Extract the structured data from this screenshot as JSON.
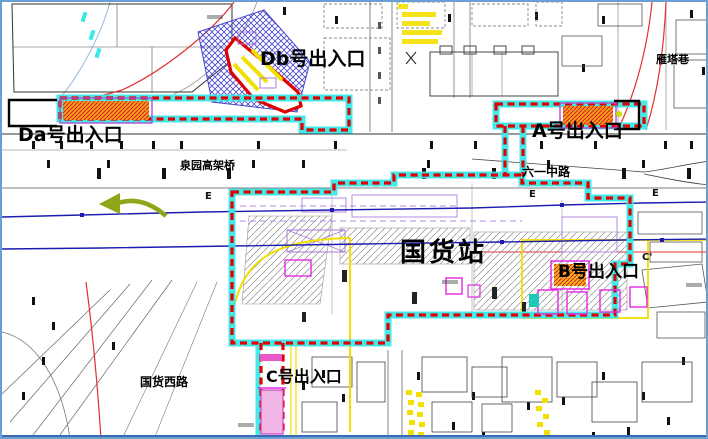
{
  "map": {
    "station_label": "国货站",
    "entrances": {
      "da": "Da号出入口",
      "db": "Db号出入口",
      "a": "A号出入口",
      "b": "B号出入口",
      "c": "C号出入口"
    },
    "streets": {
      "liuyi_middle_road": "六一中路",
      "yanta_alley": "雁塔巷",
      "guohuo_west_road": "国货西路",
      "viaduct": "泉园高架桥"
    },
    "section_markers": {
      "e_west": "E",
      "e_mid": "E",
      "e_east": "E",
      "c_prime": "C'"
    },
    "icons": {
      "direction_arrow": "left-arrow-icon"
    },
    "colors": {
      "boundary_red": "#e00000",
      "highlight_cyan": "#3ae8e8",
      "entrance_orange": "#f59d1c",
      "hatch_blue": "#4747cf",
      "utility_blue": "#1c1cb0",
      "accent_magenta": "#e22ae2",
      "accent_purple": "#a87ad8",
      "accent_yellow": "#f2df00",
      "arrow_green": "#8fa51a",
      "frame_blue": "#3a6cb5"
    }
  }
}
